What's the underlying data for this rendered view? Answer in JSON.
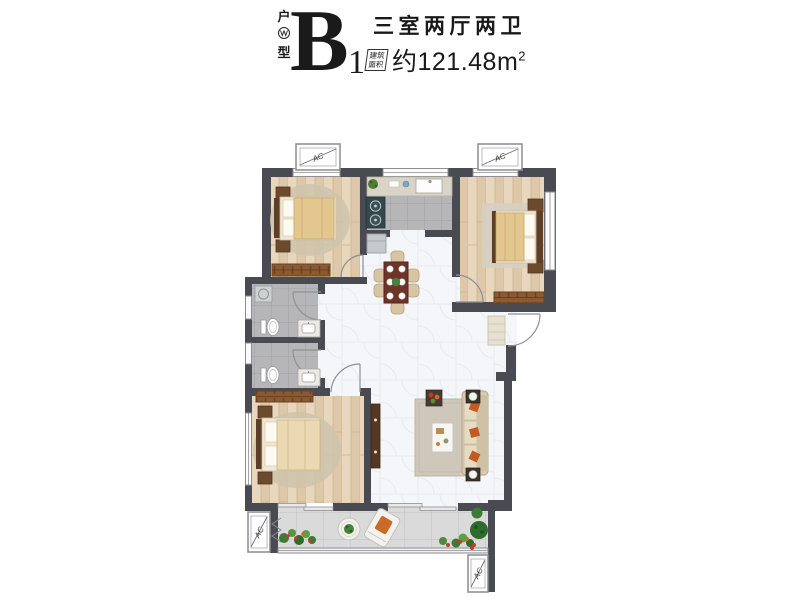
{
  "header": {
    "type_label_top": "户",
    "type_label_bottom": "型",
    "unit_letter": "B",
    "unit_number": "1",
    "title": "三室两厅两卫",
    "area_tag_line1": "建筑",
    "area_tag_line2": "面积",
    "area_value": "约121.48m",
    "area_superscript": "2"
  },
  "plan": {
    "ac_label": "AC",
    "colors": {
      "wall": "#4a4a52",
      "wood_floor": "#ddc8a9",
      "grey_tile": "#b6b6b9",
      "marble_floor": "#f5f6f9",
      "balcony_tile": "#dadada",
      "wardrobe": "#8a5a33",
      "table_wood": "#6e3427",
      "sofa": "#d8cbb1",
      "blanket": "#e2c78e",
      "accent_orange": "#c35a22",
      "plant_green": "#47823a"
    }
  }
}
